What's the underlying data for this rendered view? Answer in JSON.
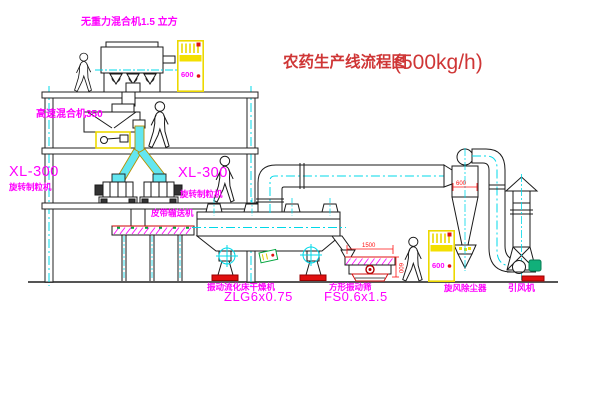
{
  "diagram": {
    "title_cn": "农药生产线流程图",
    "title_capacity": "(500kg/h)",
    "labels": {
      "gravity_mixer": "无重力混合机1.5 立方",
      "high_speed_mixer": "高速混合机350",
      "granulator_left_model": "XL-300",
      "granulator_left_name": "旋转制粒机",
      "granulator_right_model": "XL-300",
      "granulator_right_name": "旋转制粒机",
      "belt_conveyor": "皮带输送机",
      "dryer_name": "振动流化床干燥机",
      "dryer_model": "ZLG6x0.75",
      "sieve_name": "方形振动筛",
      "sieve_model": "FS0.6x1.5",
      "cyclone_name": "旋风除尘器",
      "fan_name": "引风机"
    },
    "dimensions": {
      "cyclone_diameter": "600",
      "sieve_length": "1500",
      "sieve_height": "600"
    },
    "cabinet_marking": "600",
    "colors": {
      "label_magenta": "#ff00ff",
      "title_red": "#cf3636",
      "dimension_red": "#ff1010",
      "cad_yellow": "#ecd800",
      "centerline_cyan": "#00d8e8",
      "machine_green": "#00a43c",
      "line_black": "#1a1a1a"
    }
  }
}
